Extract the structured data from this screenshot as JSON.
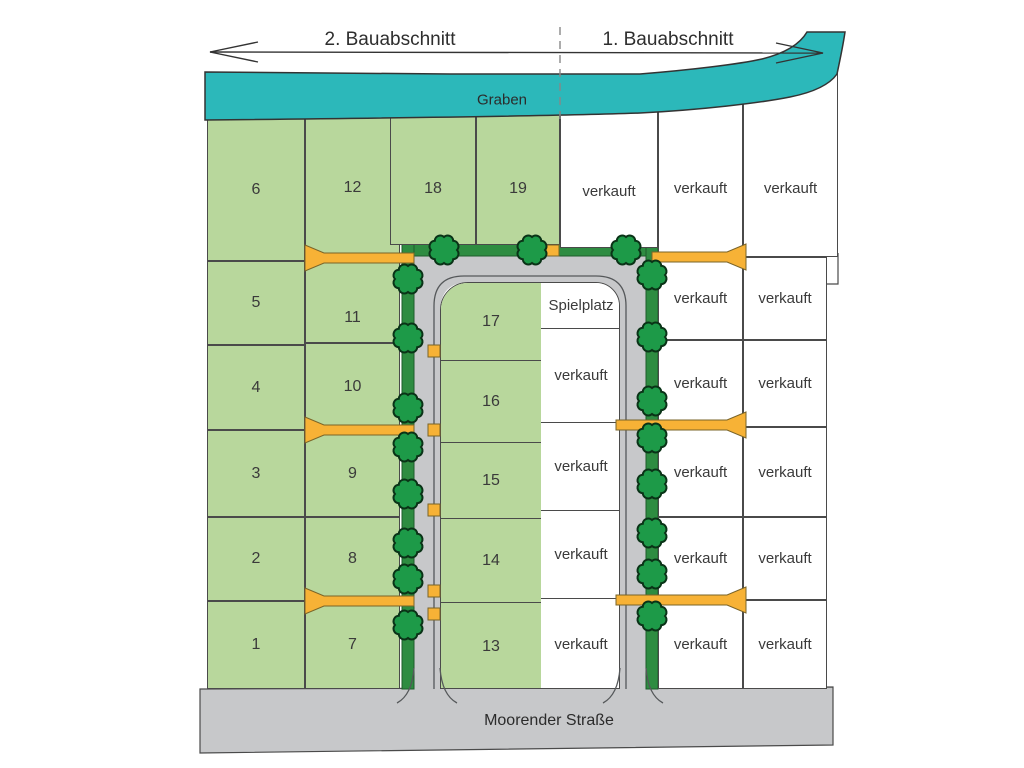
{
  "header": {
    "section_left": "2. Bauabschnitt",
    "section_right": "1. Bauabschnitt"
  },
  "map": {
    "water_label": "Graben",
    "street_label": "Moorender Straße",
    "playground_label": "Spielplatz",
    "sold_label": "verkauft",
    "available_plot_numbers": [
      "1",
      "2",
      "3",
      "4",
      "5",
      "6",
      "7",
      "8",
      "9",
      "10",
      "11",
      "12",
      "13",
      "14",
      "15",
      "16",
      "17",
      "18",
      "19"
    ],
    "counts": {
      "available_plots": 19,
      "sold_plots": 17
    },
    "colors": {
      "available_plot": "#b8d79c",
      "sold_plot": "#ffffff",
      "road": "#c7c8ca",
      "water": "#2cb8ba",
      "verge_strip": "#2e8c41",
      "tree": "#1d9a48",
      "driveway": "#f7b236"
    }
  }
}
